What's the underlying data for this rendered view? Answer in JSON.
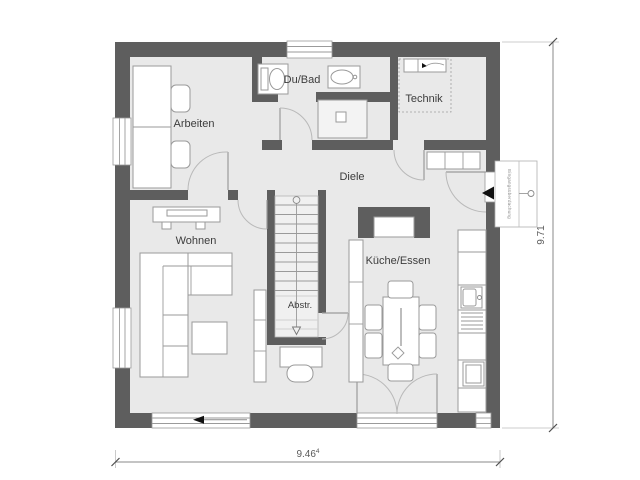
{
  "rooms": {
    "arbeiten": "Arbeiten",
    "dubad": "Du/Bad",
    "technik": "Technik",
    "diele": "Diele",
    "wohnen": "Wohnen",
    "abstr": "Abstr.",
    "kueche": "Küche/Essen"
  },
  "dimensions": {
    "width": "9.46",
    "width_sup": "4",
    "height": "9.71"
  },
  "annotations": {
    "entrance_note": "Eingangsüberdachung"
  },
  "colors": {
    "wall": "#5e5e5e",
    "floor": "#e9e9e9",
    "line": "#9a9a9a",
    "ink": "#3c3c3c"
  }
}
